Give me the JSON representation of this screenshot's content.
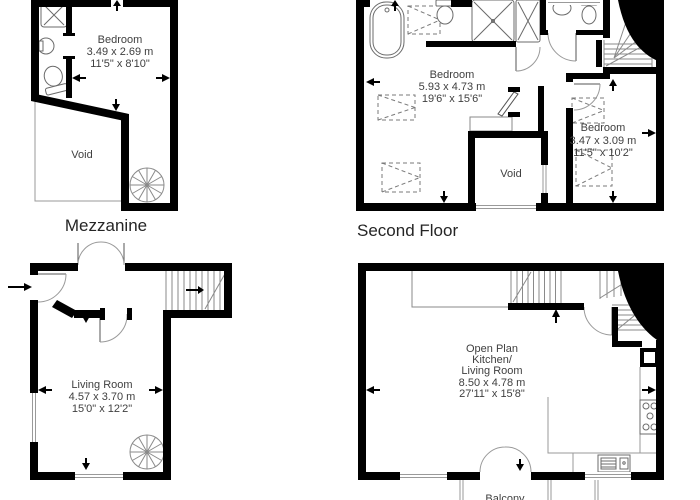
{
  "page": {
    "background": "#ffffff"
  },
  "colors": {
    "wall": "#000000",
    "fixture_line": "#6b6b6b",
    "window_line": "#9a9a9a",
    "room_text": "#3f3f3f",
    "floor_label_text": "#252525"
  },
  "plans": {
    "mezzanine": {
      "floor_label": "Mezzanine",
      "bedroom": {
        "name": "Bedroom",
        "size_metric": "3.49 x 2.69 m",
        "size_imperial": "11'5\" x 8'10\""
      },
      "void_label": "Void"
    },
    "second_floor": {
      "floor_label": "Second Floor",
      "bedroom_large": {
        "name": "Bedroom",
        "size_metric": "5.93 x 4.73 m",
        "size_imperial": "19'6\" x 15'6\""
      },
      "bedroom_small": {
        "name": "Bedroom",
        "size_metric": "3.47 x 3.09 m",
        "size_imperial": "11'5\" x 10'2\""
      },
      "void_label": "Void"
    },
    "first_floor": {
      "living_room": {
        "name": "Living Room",
        "size_metric": "4.57 x 3.70 m",
        "size_imperial": "15'0\" x 12'2\""
      }
    },
    "ground_floor": {
      "open_plan": {
        "name_line1": "Open Plan",
        "name_line2": "Kitchen/",
        "name_line3": "Living Room",
        "size_metric": "8.50 x 4.78 m",
        "size_imperial": "27'11\" x 15'8\""
      },
      "balcony_label": "Balcony"
    }
  },
  "symbols": [
    "bathtub",
    "shower",
    "toilet",
    "sink",
    "spiral-staircase",
    "staircase",
    "wardrobe",
    "door-swing",
    "window",
    "entry-arrow",
    "hob",
    "kitchen-sink",
    "void-area"
  ]
}
